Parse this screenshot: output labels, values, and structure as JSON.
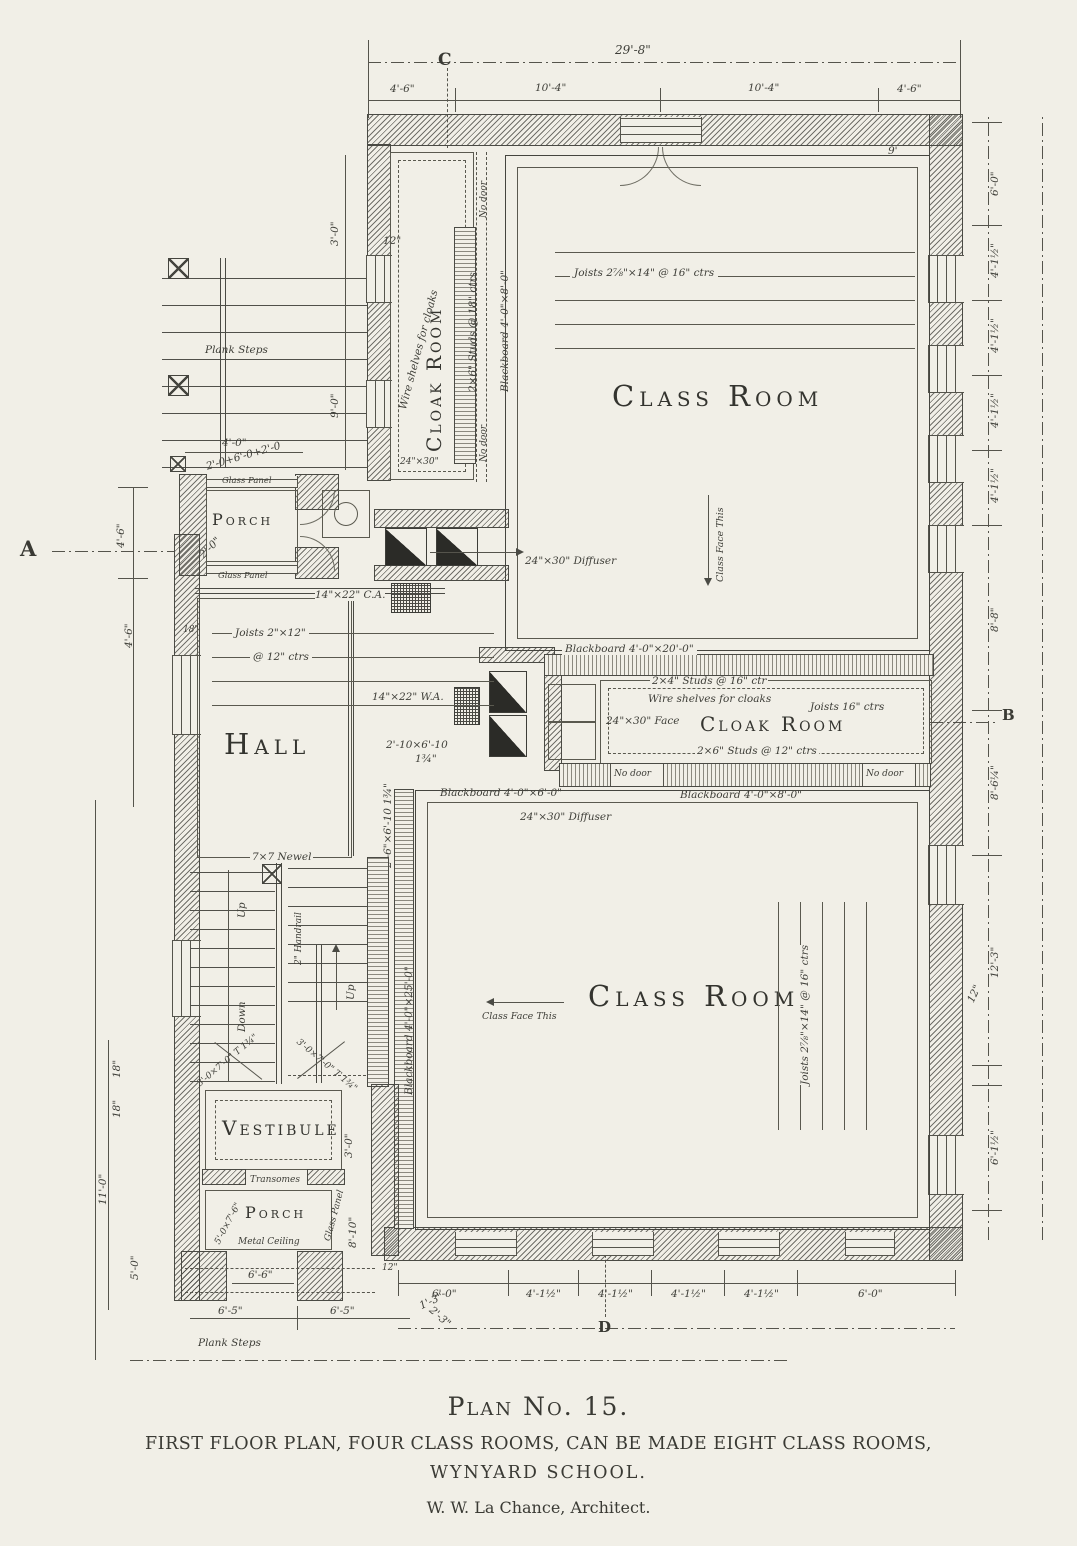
{
  "title_block": {
    "plan_no": "Plan No. 15.",
    "line1": "FIRST FLOOR PLAN, FOUR CLASS ROOMS, CAN BE MADE EIGHT CLASS ROOMS,",
    "line2": "WYNYARD SCHOOL.",
    "architect": "W. W. La Chance, Architect."
  },
  "rooms": {
    "class_room": "Class Room",
    "cloak_room": "Cloak Room",
    "hall": "Hall",
    "vestibule": "Vestibule",
    "porch": "Porch"
  },
  "markers": {
    "a": "A",
    "b": "B",
    "c": "C",
    "d": "D"
  },
  "dims": {
    "overall_width": "29'-8\"",
    "side_4_6": "4'-6\"",
    "bay_10_4": "10'-4\"",
    "bay_4_1h": "4'-1½\"",
    "bay_6_0": "6'-0\"",
    "d_8_8": "8'-8\"",
    "d_8_6q": "8'-6¼\"",
    "d_12_3": "12'-3\"",
    "d_12": "12\"",
    "d_6_1h": "6'-1½\"",
    "d_18": "18\"",
    "d_11_0": "11'-0\"",
    "d_5_0": "5'-0\"",
    "d_9_0": "9'-0\"",
    "d_3_0": "3'-0\"",
    "d_4_0": "4'-0\"",
    "d_2_0": "2'-0\"",
    "d_6_6": "6'-6\"",
    "d_6_5": "6'-5\"",
    "d_1_3": "1'-3\"",
    "d_2_3": "2'-3\"",
    "d_8_10": "8'-10\"",
    "d_9": "9'",
    "porch_opening": "2'-0+6'-0+2'-0"
  },
  "notes": {
    "plank_steps": "Plank Steps",
    "glass_panel": "Glass Panel",
    "hall_joists_1": "Joists 2\"×12\"",
    "hall_joists_2": "@ 12\" ctrs",
    "duct_ca": "14\"×22\" C.A.",
    "duct_wa": "14\"×22\" W.A.",
    "door_2_10": "2'-10×6'-10",
    "thickness": "1¾\"",
    "door_2_6": "2'-6\"×6'-10 1¾\"",
    "wire_shelves": "Wire shelves for cloaks",
    "studs_2x6_18": "2×6\" Studs @ 18\" ctrs",
    "studs_2x4_16": "2×4\" Studs @ 16\" ctr",
    "studs_2x6_12": "2×6\" Studs @ 12\" ctrs",
    "joists_16": "Joists 16\" ctrs",
    "bb_20": "Blackboard 4'-0\"×20'-0\"",
    "bb_25": "Blackboard 4'-0\"×25'-0\"",
    "bb_8": "Blackboard 4'-0\"×8'-0\"",
    "bb_6": "Blackboard 4'-0\"×6'-0\"",
    "no_door": "No door",
    "reg_24_30": "24\"×30\"",
    "class_joists": "Joists 2⅞\"×14\" @ 16\" ctrs",
    "class_face": "Class Face This",
    "diffuser": "24\"×30\" Diffuser",
    "face_24_30": "24\"×30\" Face",
    "newel": "7×7 Newel",
    "up": "Up",
    "down": "Down",
    "handrail": "2\" Handrail",
    "door_3_0": "3'-0×7'-0\" T 1¾\"",
    "door_5_0": "5'-0×7'-6\"",
    "transomes": "Transomes",
    "metal_ceiling": "Metal Ceiling"
  }
}
